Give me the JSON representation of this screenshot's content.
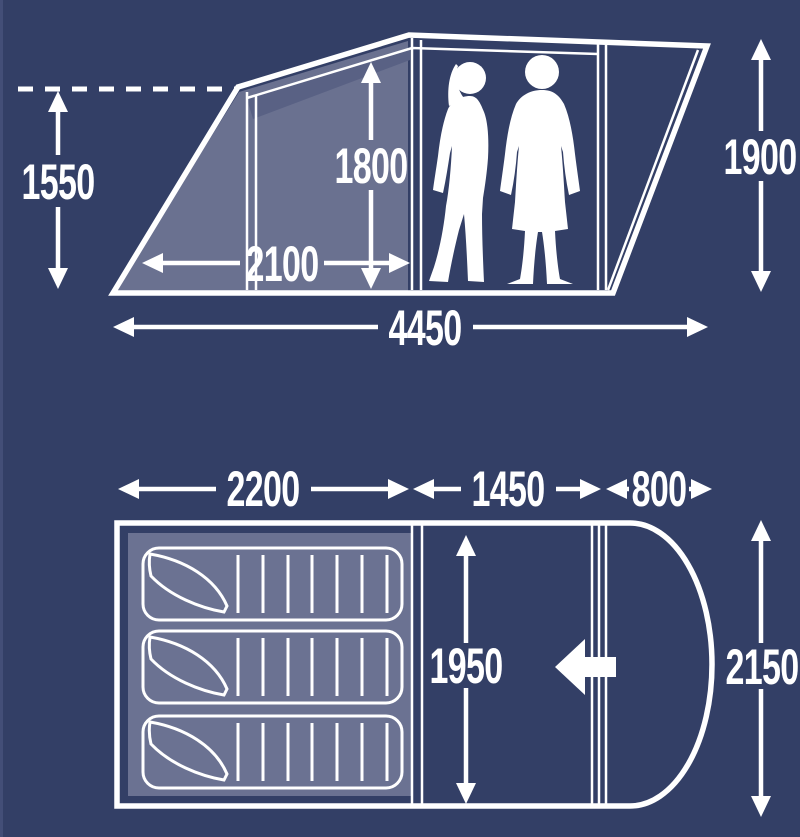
{
  "diagram_title": "Tent dimensions diagram",
  "colors": {
    "background": "#333f66",
    "panel_shade": "#6a7190",
    "panel_shade_dark": "#596184",
    "floor_shade": "#6b7292",
    "line": "#ffffff",
    "edge_highlight": "#46517a"
  },
  "side_view": {
    "height_left_label": "1550",
    "inner_height_label": "1800",
    "inner_width_label": "2100",
    "total_width_label": "4450",
    "height_right_label": "1900"
  },
  "floor_plan": {
    "bedroom_width_label": "2200",
    "living_width_label": "1450",
    "porch_width_label": "800",
    "living_depth_label": "1950",
    "total_depth_label": "2150"
  }
}
